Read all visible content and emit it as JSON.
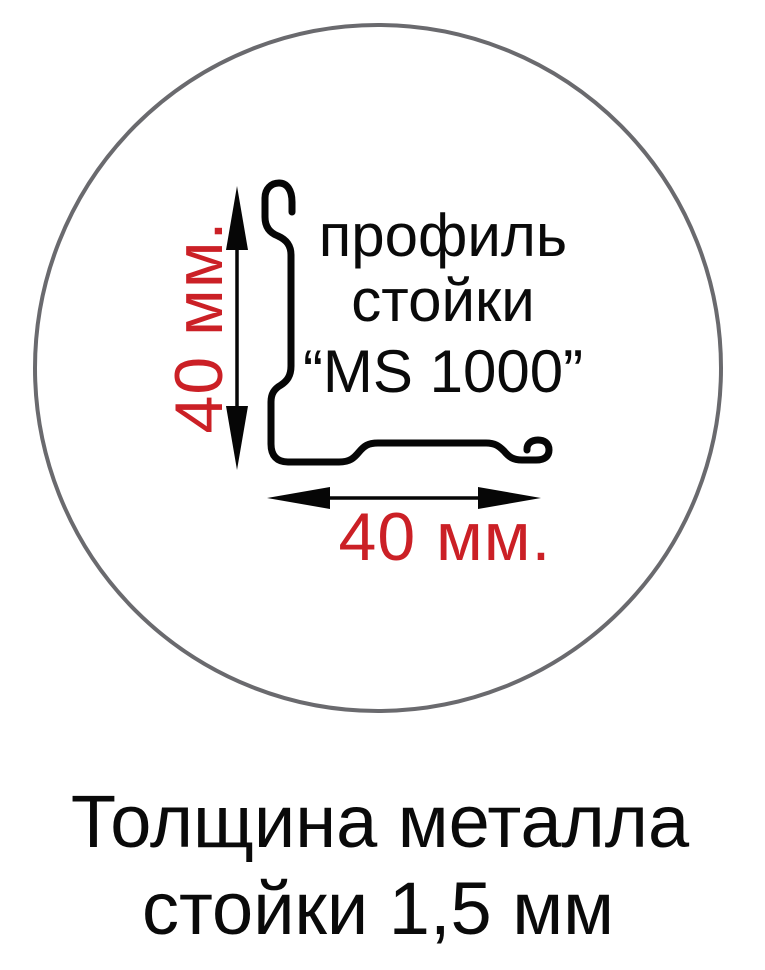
{
  "diagram": {
    "profile_label": {
      "line1": "профиль",
      "line2": "стойки",
      "line3": "“MS 1000”"
    },
    "dimensions": {
      "height_label": "40 мм.",
      "width_label": "40 мм."
    }
  },
  "caption": {
    "line1": "Толщина металла",
    "line2": "стойки 1,5 мм"
  },
  "colors": {
    "dimension_text": "#cb2026",
    "circle_stroke": "#6a6a6e",
    "line_color": "#060606",
    "background": "#ffffff"
  }
}
